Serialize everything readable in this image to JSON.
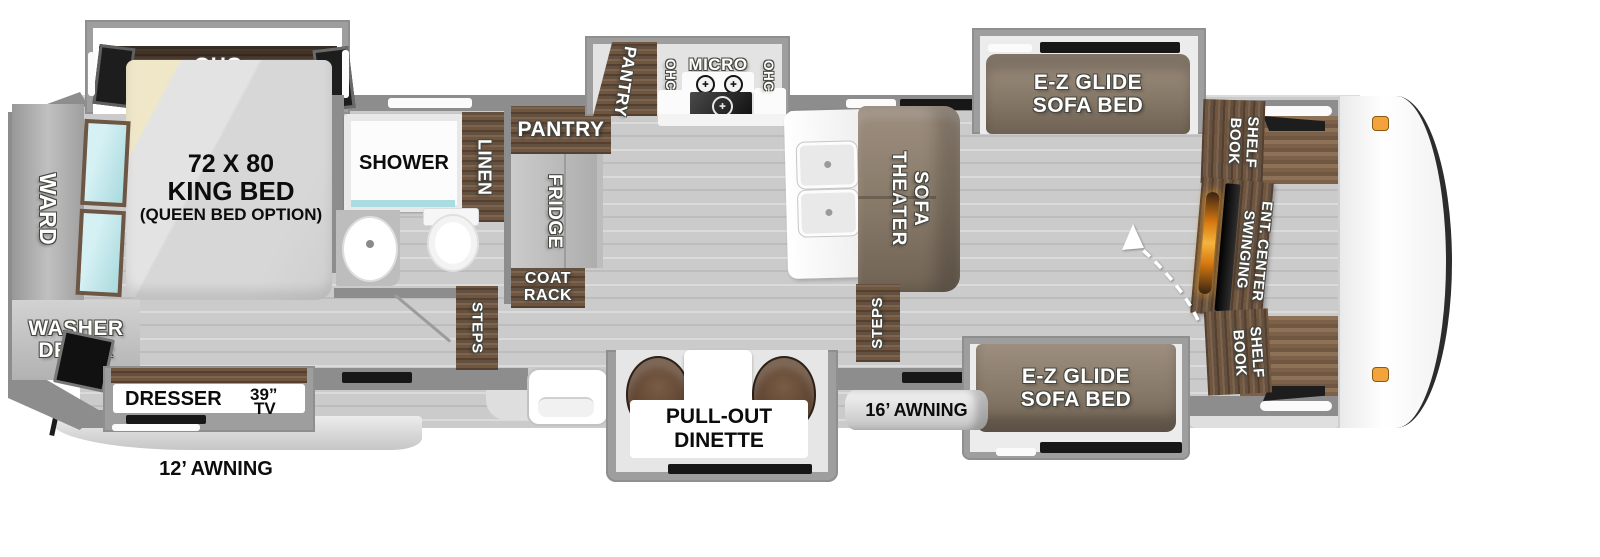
{
  "labels": {
    "ohc": "OHC",
    "bed_size": "72 X 80",
    "bed_type": "KING BED",
    "bed_option": "(QUEEN BED OPTION)",
    "ward": "WARD",
    "washer": "WASHER",
    "dryer": "DRYER",
    "dresser": "DRESSER",
    "tv_size": "39”",
    "tv": "TV",
    "awning_rear": "12’ AWNING",
    "shower": "SHOWER",
    "linen": "LINEN",
    "pantry": "PANTRY",
    "fridge": "FRIDGE",
    "coat": "COAT",
    "rack": "RACK",
    "steps": "STEPS",
    "micro": "MICRO",
    "dinette1": "PULL-OUT",
    "dinette2": "DINETTE",
    "awning_main": "16’ AWNING",
    "theater": "THEATER",
    "sofa": "SOFA",
    "ez_glide": "E-Z GLIDE",
    "sofa_bed": "SOFA BED",
    "book": "BOOK",
    "shelf": "SHELF",
    "swinging": "SWINGING",
    "ent_center": "ENT. CENTER"
  },
  "colors": {
    "wall": "#8d8d8d",
    "floor": "#cbcbcb",
    "cabinet_wood": "#6e563f",
    "sofa": "#8a7c6e",
    "fireplace": "#e89020",
    "mirror": "#bfe3e8",
    "clearance_light": "#f2a33c"
  }
}
